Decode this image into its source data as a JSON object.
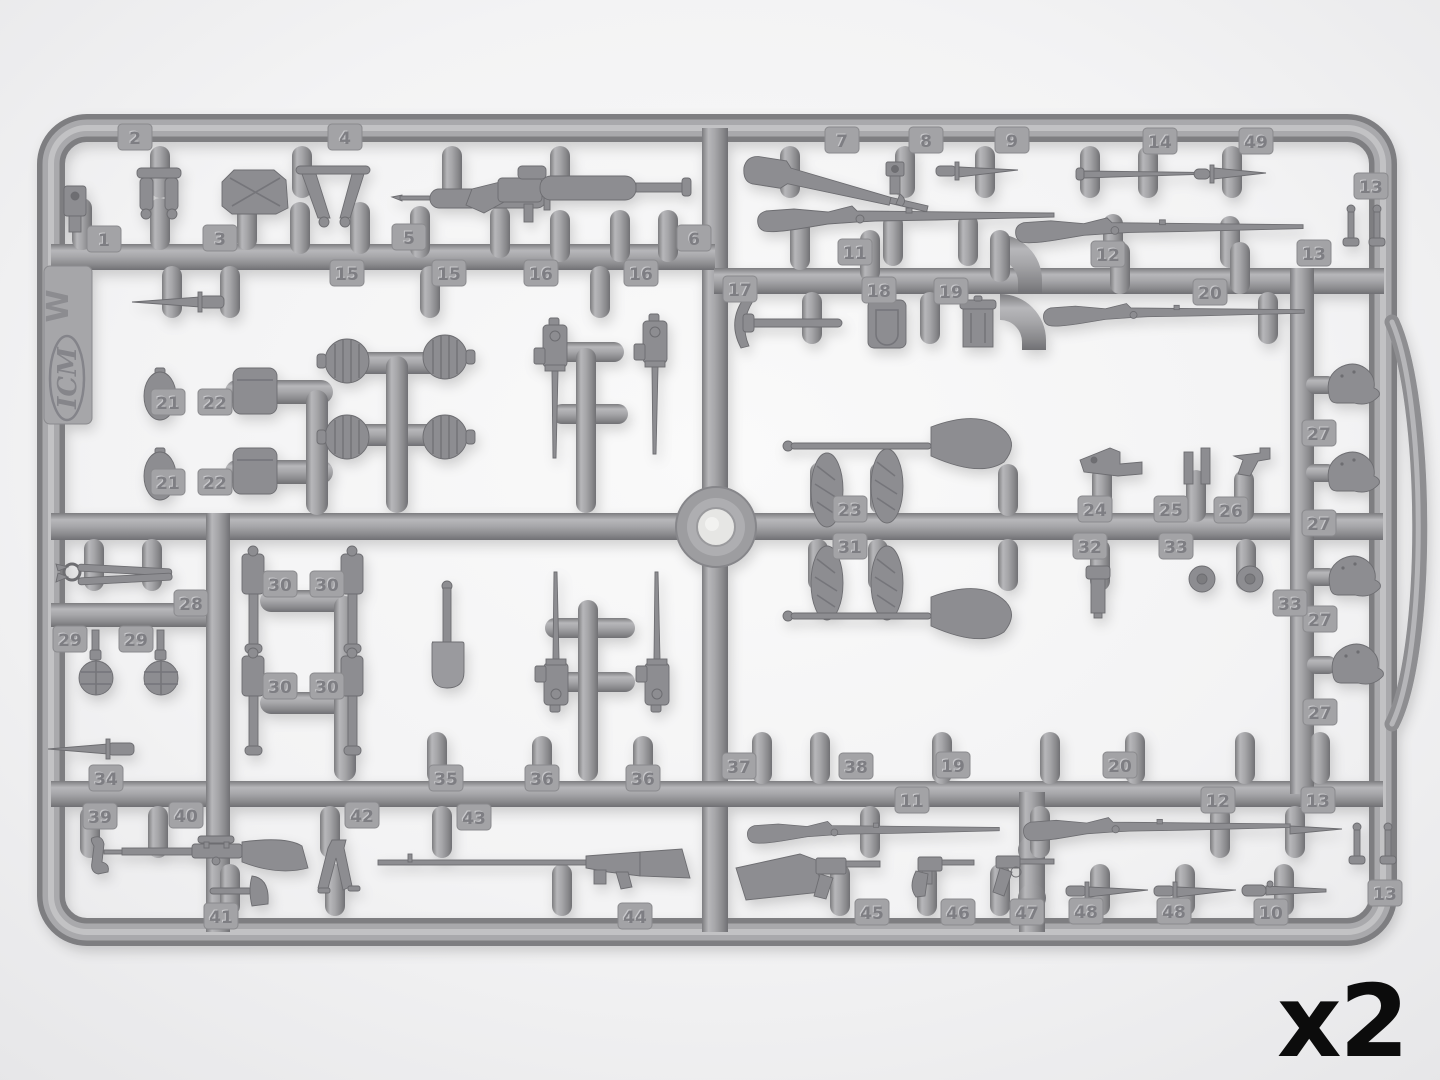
{
  "quantity_label": "x2",
  "branding": {
    "logo_text": "ICM",
    "mold_letter": "W"
  },
  "colors": {
    "background": "#efeff0",
    "plastic": "#9a9a9d",
    "plastic_dark": "#737377",
    "plastic_light": "#bfbfc2",
    "part": "#8d8d91",
    "tag_text": "#7e7e83",
    "overlay_text": "#0c0c0c"
  },
  "sprue": {
    "part_tags": [
      {
        "label": "2",
        "x": 135,
        "y": 137
      },
      {
        "label": "4",
        "x": 345,
        "y": 137
      },
      {
        "label": "1",
        "x": 104,
        "y": 239
      },
      {
        "label": "3",
        "x": 220,
        "y": 238
      },
      {
        "label": "5",
        "x": 409,
        "y": 237
      },
      {
        "label": "6",
        "x": 694,
        "y": 238
      },
      {
        "label": "15",
        "x": 347,
        "y": 273
      },
      {
        "label": "15",
        "x": 449,
        "y": 273
      },
      {
        "label": "16",
        "x": 541,
        "y": 273
      },
      {
        "label": "16",
        "x": 641,
        "y": 273
      },
      {
        "label": "7",
        "x": 842,
        "y": 140
      },
      {
        "label": "8",
        "x": 926,
        "y": 140
      },
      {
        "label": "9",
        "x": 1012,
        "y": 140
      },
      {
        "label": "14",
        "x": 1160,
        "y": 141
      },
      {
        "label": "49",
        "x": 1256,
        "y": 141
      },
      {
        "label": "13",
        "x": 1371,
        "y": 186
      },
      {
        "label": "11",
        "x": 855,
        "y": 252
      },
      {
        "label": "12",
        "x": 1108,
        "y": 254
      },
      {
        "label": "13",
        "x": 1314,
        "y": 253
      },
      {
        "label": "17",
        "x": 740,
        "y": 289
      },
      {
        "label": "18",
        "x": 879,
        "y": 290
      },
      {
        "label": "19",
        "x": 951,
        "y": 291
      },
      {
        "label": "20",
        "x": 1210,
        "y": 292
      },
      {
        "label": "21",
        "x": 168,
        "y": 402
      },
      {
        "label": "22",
        "x": 215,
        "y": 402
      },
      {
        "label": "21",
        "x": 168,
        "y": 482
      },
      {
        "label": "22",
        "x": 215,
        "y": 482
      },
      {
        "label": "23",
        "x": 850,
        "y": 509
      },
      {
        "label": "24",
        "x": 1095,
        "y": 509
      },
      {
        "label": "25",
        "x": 1171,
        "y": 509
      },
      {
        "label": "26",
        "x": 1231,
        "y": 510
      },
      {
        "label": "31",
        "x": 850,
        "y": 546
      },
      {
        "label": "32",
        "x": 1090,
        "y": 546
      },
      {
        "label": "33",
        "x": 1176,
        "y": 546
      },
      {
        "label": "27",
        "x": 1319,
        "y": 433
      },
      {
        "label": "27",
        "x": 1319,
        "y": 523
      },
      {
        "label": "27",
        "x": 1320,
        "y": 619
      },
      {
        "label": "27",
        "x": 1320,
        "y": 712
      },
      {
        "label": "33",
        "x": 1290,
        "y": 603
      },
      {
        "label": "28",
        "x": 191,
        "y": 603
      },
      {
        "label": "29",
        "x": 70,
        "y": 639
      },
      {
        "label": "29",
        "x": 136,
        "y": 639
      },
      {
        "label": "30",
        "x": 280,
        "y": 584
      },
      {
        "label": "30",
        "x": 327,
        "y": 584
      },
      {
        "label": "30",
        "x": 280,
        "y": 686
      },
      {
        "label": "30",
        "x": 327,
        "y": 686
      },
      {
        "label": "34",
        "x": 106,
        "y": 778
      },
      {
        "label": "35",
        "x": 446,
        "y": 778
      },
      {
        "label": "36",
        "x": 542,
        "y": 778
      },
      {
        "label": "36",
        "x": 643,
        "y": 778
      },
      {
        "label": "37",
        "x": 739,
        "y": 766
      },
      {
        "label": "38",
        "x": 856,
        "y": 766
      },
      {
        "label": "19",
        "x": 953,
        "y": 765
      },
      {
        "label": "20",
        "x": 1120,
        "y": 765
      },
      {
        "label": "39",
        "x": 100,
        "y": 816
      },
      {
        "label": "40",
        "x": 186,
        "y": 815
      },
      {
        "label": "42",
        "x": 362,
        "y": 815
      },
      {
        "label": "43",
        "x": 474,
        "y": 817
      },
      {
        "label": "41",
        "x": 221,
        "y": 916
      },
      {
        "label": "44",
        "x": 635,
        "y": 916
      },
      {
        "label": "11",
        "x": 912,
        "y": 800
      },
      {
        "label": "12",
        "x": 1218,
        "y": 800
      },
      {
        "label": "13",
        "x": 1318,
        "y": 800
      },
      {
        "label": "13",
        "x": 1385,
        "y": 893
      },
      {
        "label": "45",
        "x": 872,
        "y": 912
      },
      {
        "label": "46",
        "x": 958,
        "y": 912
      },
      {
        "label": "47",
        "x": 1027,
        "y": 912
      },
      {
        "label": "48",
        "x": 1086,
        "y": 911
      },
      {
        "label": "48",
        "x": 1174,
        "y": 911
      },
      {
        "label": "10",
        "x": 1271,
        "y": 912
      }
    ]
  }
}
